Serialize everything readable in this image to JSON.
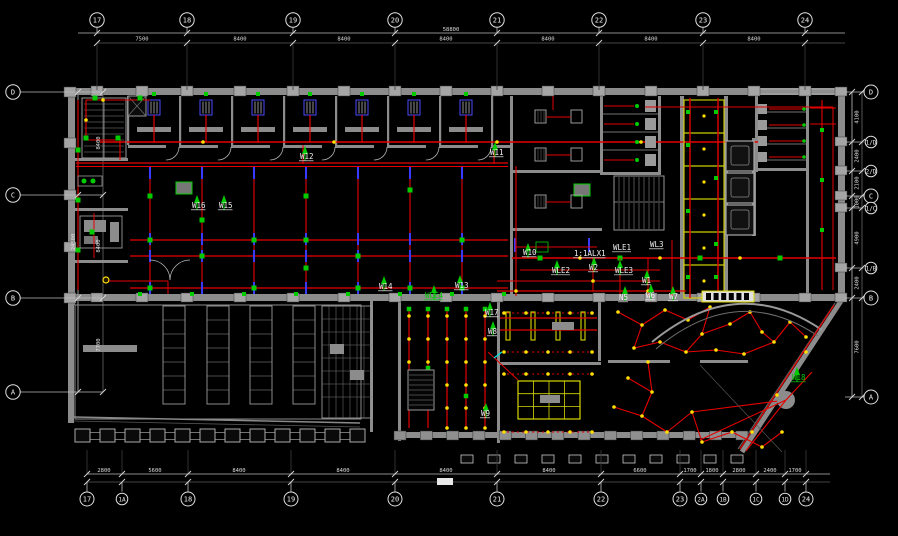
{
  "drawing": {
    "kind": "electrical-lighting-floor-plan",
    "background": "#000000"
  },
  "colors": {
    "wall": "#8c8c8c",
    "column": "#a5a5a5",
    "wire": "#e60000",
    "fixture_green": "#00cc00",
    "column_dash_blue": "#3a3aff",
    "accent_yellow": "#d8d800",
    "dot_yellow": "#ffe000",
    "dim_line": "#bdbdbd",
    "text": "#f0f0f0",
    "cyan": "#00e5e5"
  },
  "axes": {
    "top": {
      "items": [
        {
          "label": "17",
          "x": 97
        },
        {
          "label": "18",
          "x": 187
        },
        {
          "label": "19",
          "x": 293
        },
        {
          "label": "20",
          "x": 395
        },
        {
          "label": "21",
          "x": 497
        },
        {
          "label": "22",
          "x": 599
        },
        {
          "label": "23",
          "x": 703
        },
        {
          "label": "24",
          "x": 805
        }
      ]
    },
    "bottom": {
      "items": [
        {
          "label": "17",
          "x": 87
        },
        {
          "label": "1A",
          "x": 122,
          "minor": true
        },
        {
          "label": "18",
          "x": 188
        },
        {
          "label": "19",
          "x": 291
        },
        {
          "label": "20",
          "x": 395
        },
        {
          "label": "21",
          "x": 497
        },
        {
          "label": "22",
          "x": 601
        },
        {
          "label": "23",
          "x": 680
        },
        {
          "label": "2A",
          "x": 701,
          "minor": true
        },
        {
          "label": "1B",
          "x": 723,
          "minor": true
        },
        {
          "label": "1C",
          "x": 756,
          "minor": true
        },
        {
          "label": "1D",
          "x": 785,
          "minor": true
        },
        {
          "label": "24",
          "x": 806
        }
      ]
    },
    "left": {
      "items": [
        {
          "label": "D",
          "y": 92
        },
        {
          "label": "C",
          "y": 195
        },
        {
          "label": "B",
          "y": 298
        },
        {
          "label": "A",
          "y": 392
        }
      ]
    },
    "right": {
      "items": [
        {
          "label": "D",
          "y": 92
        },
        {
          "label": "1/D",
          "y": 142,
          "minor": true
        },
        {
          "label": "2/D",
          "y": 171,
          "minor": true
        },
        {
          "label": "C",
          "y": 196
        },
        {
          "label": "1/C",
          "y": 208,
          "minor": true
        },
        {
          "label": "1/B",
          "y": 268,
          "minor": true
        },
        {
          "label": "B",
          "y": 298
        },
        {
          "label": "A",
          "y": 397
        }
      ]
    }
  },
  "dimensions": {
    "top": {
      "total": {
        "text": "58800",
        "x": 451,
        "y": 31
      },
      "segments": [
        {
          "text": "7500",
          "x": 142
        },
        {
          "text": "8400",
          "x": 240
        },
        {
          "text": "8400",
          "x": 344
        },
        {
          "text": "8400",
          "x": 446
        },
        {
          "text": "8400",
          "x": 548
        },
        {
          "text": "8400",
          "x": 651
        },
        {
          "text": "8400",
          "x": 754
        }
      ]
    },
    "bottom": {
      "segments": [
        {
          "text": "2800",
          "x": 104
        },
        {
          "text": "5600",
          "x": 155
        },
        {
          "text": "8400",
          "x": 239
        },
        {
          "text": "8400",
          "x": 343
        },
        {
          "text": "8400",
          "x": 446
        },
        {
          "text": "8400",
          "x": 549
        },
        {
          "text": "6600",
          "x": 640
        },
        {
          "text": "1700",
          "x": 690
        },
        {
          "text": "1800",
          "x": 712
        },
        {
          "text": "2800",
          "x": 739
        },
        {
          "text": "2400",
          "x": 770
        },
        {
          "text": "1700",
          "x": 795
        }
      ]
    },
    "left": {
      "total": {
        "text": "24500",
        "y": 242
      },
      "segments": [
        {
          "text": "8400",
          "y": 143
        },
        {
          "text": "8400",
          "y": 246
        },
        {
          "text": "7700",
          "y": 345
        }
      ]
    },
    "right": {
      "segments": [
        {
          "text": "4100",
          "y": 117
        },
        {
          "text": "2400",
          "y": 156
        },
        {
          "text": "2100",
          "y": 183
        },
        {
          "text": "1000",
          "y": 202
        },
        {
          "text": "4900",
          "y": 238
        },
        {
          "text": "2400",
          "y": 283
        },
        {
          "text": "7600",
          "y": 347
        }
      ]
    }
  },
  "circuit_labels": [
    {
      "text": "W12",
      "x": 300,
      "y": 159,
      "color": "#f0f0f0"
    },
    {
      "text": "W11",
      "x": 490,
      "y": 155,
      "color": "#f0f0f0"
    },
    {
      "text": "W16",
      "x": 192,
      "y": 208,
      "color": "#f0f0f0"
    },
    {
      "text": "W15",
      "x": 219,
      "y": 208,
      "color": "#f0f0f0"
    },
    {
      "text": "W14",
      "x": 379,
      "y": 289,
      "color": "#f0f0f0"
    },
    {
      "text": "W13",
      "x": 455,
      "y": 288,
      "color": "#f0f0f0"
    },
    {
      "text": "WLE4",
      "x": 425,
      "y": 298,
      "color": "#00cc00"
    },
    {
      "text": "W10",
      "x": 523,
      "y": 255,
      "color": "#f0f0f0"
    },
    {
      "text": "1:1ALX1",
      "x": 574,
      "y": 256,
      "color": "#f0f0f0"
    },
    {
      "text": "WLE1",
      "x": 613,
      "y": 250,
      "color": "#f0f0f0"
    },
    {
      "text": "WL3",
      "x": 650,
      "y": 247,
      "color": "#f0f0f0"
    },
    {
      "text": "WLE2",
      "x": 552,
      "y": 273,
      "color": "#f0f0f0"
    },
    {
      "text": "W2",
      "x": 589,
      "y": 270,
      "color": "#f0f0f0"
    },
    {
      "text": "WLE3",
      "x": 615,
      "y": 273,
      "color": "#f0f0f0"
    },
    {
      "text": "W1",
      "x": 642,
      "y": 283,
      "color": "#f0f0f0"
    },
    {
      "text": "N5",
      "x": 619,
      "y": 300,
      "color": "#f0f0f0"
    },
    {
      "text": "W6",
      "x": 646,
      "y": 298,
      "color": "#f0f0f0"
    },
    {
      "text": "W7",
      "x": 669,
      "y": 299,
      "color": "#f0f0f0"
    },
    {
      "text": "W17",
      "x": 485,
      "y": 315,
      "color": "#f0f0f0"
    },
    {
      "text": "W8",
      "x": 488,
      "y": 334,
      "color": "#f0f0f0"
    },
    {
      "text": "W9",
      "x": 481,
      "y": 416,
      "color": "#f0f0f0"
    },
    {
      "text": "W18",
      "x": 792,
      "y": 380,
      "color": "#00cc00"
    }
  ]
}
